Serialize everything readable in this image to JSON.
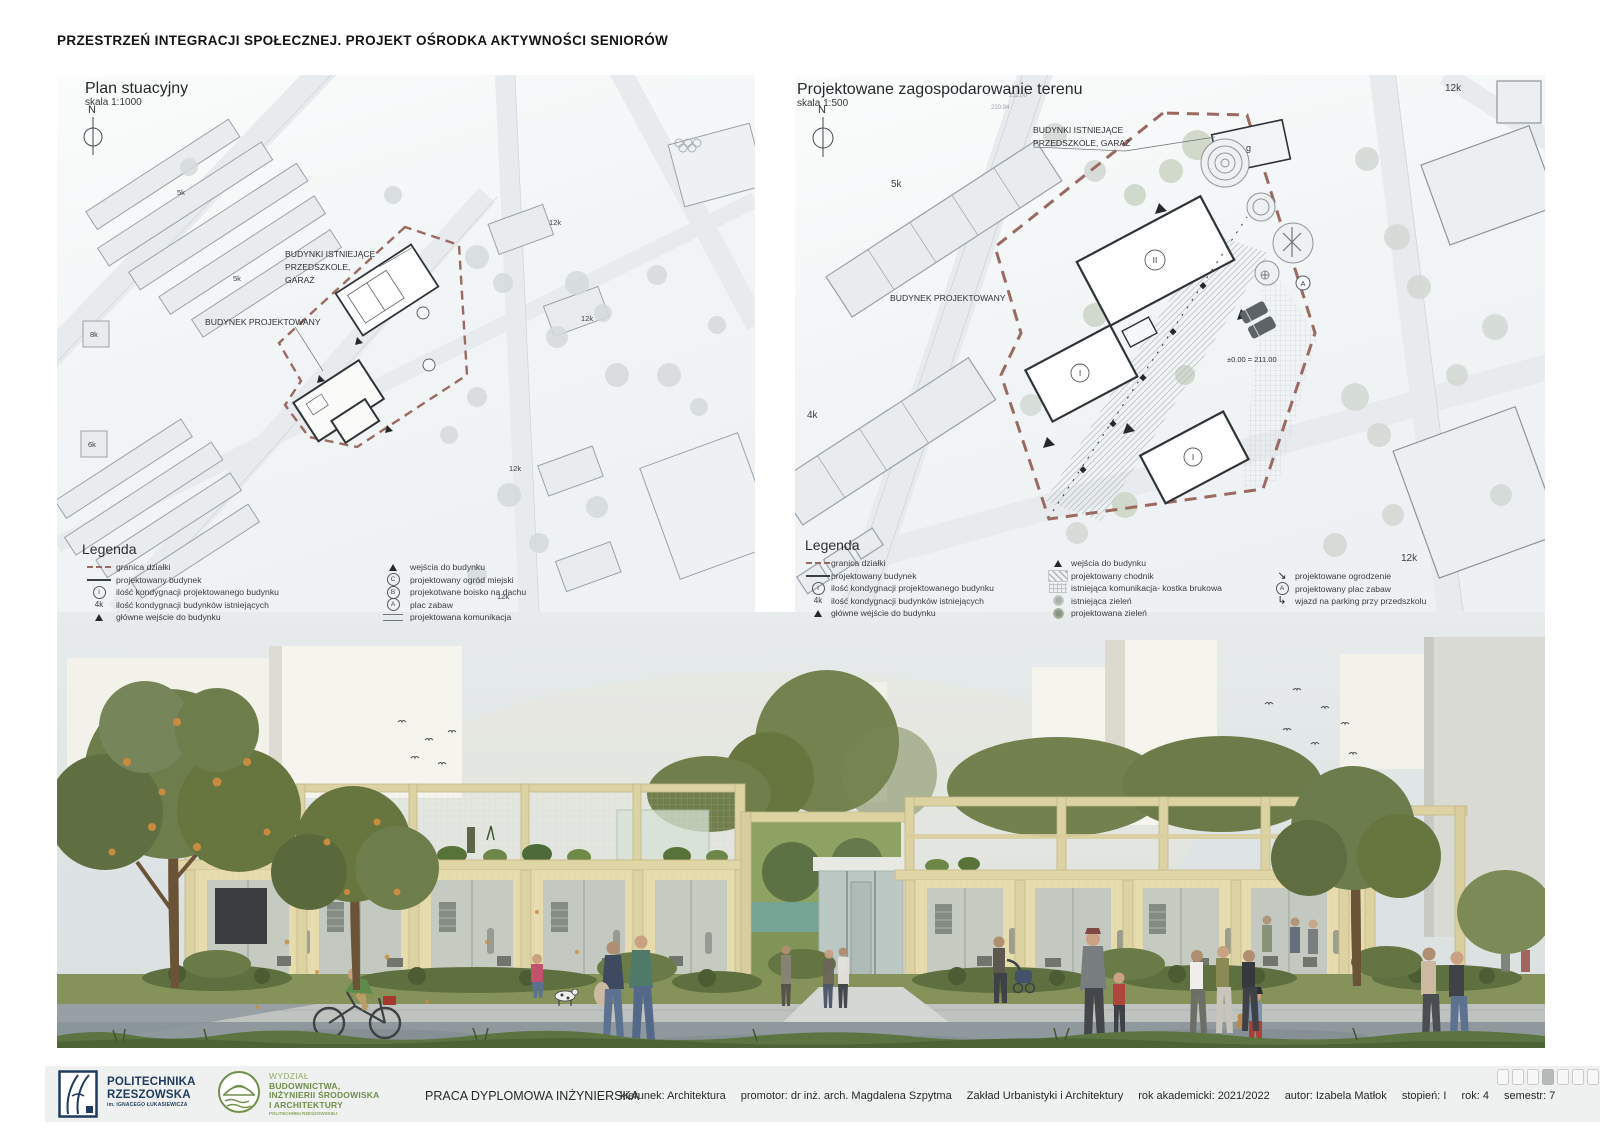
{
  "title": "PRZESTRZEŃ INTEGRACJI SPOŁECZNEJ. PROJEKT OŚRODKA AKTYWNOŚCI SENIORÓW",
  "plan_left": {
    "title": "Plan stuacyjny",
    "scale": "skala 1:1000",
    "north": "N",
    "label_existing_1": "BUDYNKI ISTNIEJĄCE",
    "label_existing_2": "PRZEDSZKOLE,",
    "label_existing_3": "GARAŻ",
    "label_proposed": "BUDYNEK PROJEKTOWANY",
    "ann": {
      "a1": "12k",
      "a2": "12k",
      "a3": "12k",
      "a4": "12k",
      "a5": "5k",
      "a6": "8k",
      "a7": "6k",
      "a8": "5k"
    },
    "legend": {
      "title": "Legenda",
      "col1": [
        {
          "label": "granica działki"
        },
        {
          "label": "projektowany budynek"
        },
        {
          "sym": "I",
          "label": "ilość kondygnacji projektowanego budynku"
        },
        {
          "sym": "4k",
          "label": "ilość kondygnacji budynków istniejących"
        },
        {
          "label": "główne wejście do budynku"
        }
      ],
      "col2": [
        {
          "label": "wejścia do budynku"
        },
        {
          "sym": "C",
          "label": "projektowany ogród miejski"
        },
        {
          "sym": "B",
          "label": "projekotwane boisko na dachu"
        },
        {
          "sym": "A",
          "label": "plac zabaw"
        },
        {
          "label": "projektowana komunikacja"
        }
      ]
    }
  },
  "plan_right": {
    "title": "Projektowane zagospodarowanie terenu",
    "scale": "skala 1:500",
    "north": "N",
    "label_existing_1": "BUDYNKI ISTNIEJĄCE",
    "label_existing_2": "PRZEDSZKOLE, GARAŻ",
    "label_proposed": "BUDYNEK PROJEKTOWANY",
    "elevation": "±0.00 = 211.00",
    "ann": {
      "a1": "12k",
      "a2": "5k",
      "a3": "4k",
      "a4": "12k",
      "a5": "g",
      "a6": "II",
      "a7": "I",
      "a8": "I",
      "a9": "A",
      "a10": "211.00",
      "a11": "210.94"
    },
    "legend": {
      "title": "Legenda",
      "col1": [
        {
          "label": "granica działki"
        },
        {
          "label": "projektowany budynek"
        },
        {
          "sym": "I",
          "label": "ilość kondygnacji projektowanego budynku"
        },
        {
          "sym": "4k",
          "label": "ilość kondygnacji budynków istniejących"
        },
        {
          "label": "główne wejście do budynku"
        }
      ],
      "col2": [
        {
          "label": "wejścia do budynku"
        },
        {
          "label": "projektowany chodnik"
        },
        {
          "label": "istniejąca komunikacja- kostka brukowa"
        },
        {
          "label": "istniejąca zieleń"
        },
        {
          "label": "projektowana zieleń"
        }
      ],
      "col3": [
        {
          "label": "projektowane ogrodzenie"
        },
        {
          "sym": "A",
          "label": "projektowany plac zabaw"
        },
        {
          "label": "wjazd na parking przy przedszkolu"
        }
      ]
    }
  },
  "footer": {
    "university_line1": "POLITECHNIKA",
    "university_line2": "RZESZOWSKA",
    "university_sub": "im. IGNACEGO ŁUKASIEWICZA",
    "faculty_pre": "WYDZIAŁ",
    "faculty_line1": "BUDOWNICTWA,",
    "faculty_line2": "INŻYNIERII ŚRODOWISKA",
    "faculty_line3": "I ARCHITEKTURY",
    "faculty_sub": "POLITECHNIKI RZESZOWSKIEJ",
    "work_type": "PRACA DYPLOMOWA INŻYNIERSKA",
    "d1": "kierunek: Architektura",
    "d2": "promotor: dr inż. arch. Magdalena Szpytma",
    "d3": "Zakład Urbanistyki i Architektury",
    "d4": "rok akademicki: 2021/2022",
    "d5": "autor: Izabela Matłok",
    "d6": "stopień: I",
    "d7": "rok: 4",
    "d8": "semestr: 7",
    "page_indicator": {
      "total": 8,
      "active": 4
    }
  },
  "icons": {
    "fence_arrow": "↘",
    "entry_arrow": "↳"
  },
  "colors": {
    "boundary": "#9a6a60",
    "navy": "#1e3a5f",
    "green": "#6f8f4a",
    "timber": "#e0d5a5",
    "sky": "#e3e8e9"
  }
}
